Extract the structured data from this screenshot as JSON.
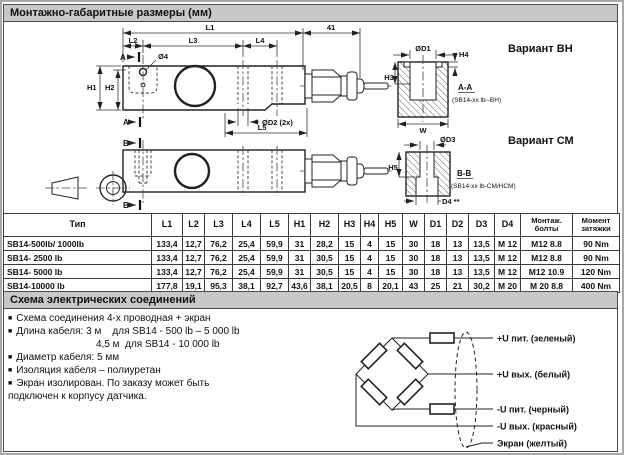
{
  "sections": {
    "dimensions": {
      "title": "Монтажно-габаритные размеры (мм)"
    },
    "connections": {
      "title": "Схема электрических соединений"
    }
  },
  "drawing": {
    "dims": {
      "L1": "L1",
      "L2": "L2",
      "L3": "L3",
      "L4": "L4",
      "L5": "L5",
      "len41": "41",
      "H1": "H1",
      "H2": "H2",
      "H3": "H3",
      "H4": "H4",
      "H5": "H5",
      "W": "W",
      "dia4": "Ø4",
      "diaD1": "ØD1",
      "diaD2": "ØD2 (2x)",
      "diaD3": "ØD3",
      "D4": "D4 **"
    },
    "marks": {
      "A": "A",
      "B": "B"
    },
    "cuts": {
      "AA": "A-A",
      "AA_note": "(SB14-xx lb--BH)",
      "BB": "B-B",
      "BB_note": "(SB14-xx lb-CM/HCM)"
    },
    "variants": {
      "BH": "Вариант ВН",
      "CM": "Вариант СМ"
    }
  },
  "table": {
    "headers": [
      "Тип",
      "L1",
      "L2",
      "L3",
      "L4",
      "L5",
      "H1",
      "H2",
      "H3",
      "H4",
      "H5",
      "W",
      "D1",
      "D2",
      "D3",
      "D4",
      "Монтаж.\nболты",
      "Момент\nзатяжки"
    ],
    "rows": [
      [
        "SB14-500lb/ 1000lb",
        "133,4",
        "12,7",
        "76,2",
        "25,4",
        "59,9",
        "31",
        "28,2",
        "15",
        "4",
        "15",
        "30",
        "18",
        "13",
        "13,5",
        "M 12",
        "M12 8.8",
        "90 Nm"
      ],
      [
        "SB14- 2500 lb",
        "133,4",
        "12,7",
        "76,2",
        "25,4",
        "59,9",
        "31",
        "30,5",
        "15",
        "4",
        "15",
        "30",
        "18",
        "13",
        "13,5",
        "M 12",
        "M12 8.8",
        "90 Nm"
      ],
      [
        "SB14- 5000 lb",
        "133,4",
        "12,7",
        "76,2",
        "25,4",
        "59,9",
        "31",
        "30,5",
        "15",
        "4",
        "15",
        "30",
        "18",
        "13",
        "13,5",
        "M 12",
        "M12 10.9",
        "120 Nm"
      ],
      [
        "SB14-10000 lb",
        "177,8",
        "19,1",
        "95,3",
        "38,1",
        "92,7",
        "43,6",
        "38,1",
        "20,5",
        "8",
        "20,1",
        "43",
        "25",
        "21",
        "30,2",
        "M 20",
        "M 20 8.8",
        "400 Nm"
      ]
    ]
  },
  "connections": {
    "bullets": [
      {
        "marker": true,
        "indent": 0,
        "text": "Схема соединения 4-х проводная + экран"
      },
      {
        "marker": true,
        "indent": 0,
        "text": "Длина кабеля: 3 м    для SB14 - 500 lb – 5 000 lb"
      },
      {
        "marker": false,
        "indent": 1,
        "text": "4,5 м  для SB14 - 10 000 lb"
      },
      {
        "marker": true,
        "indent": 0,
        "text": "Диаметр кабеля: 5 мм"
      },
      {
        "marker": true,
        "indent": 0,
        "text": "Изоляция кабеля – полиуретан"
      },
      {
        "marker": true,
        "indent": 0,
        "text": "Экран изолирован. По заказу может быть"
      },
      {
        "marker": false,
        "indent": 0,
        "text": "подключен к корпусу датчика."
      }
    ],
    "wires": [
      "+U пит. (зеленый)",
      "+U вых. (белый)",
      "-U пит. (черный)",
      "-U вых. (красный)",
      "Экран (желтый)"
    ]
  },
  "colors": {
    "header_bar": "#c8c8c8",
    "line": "#222222"
  }
}
